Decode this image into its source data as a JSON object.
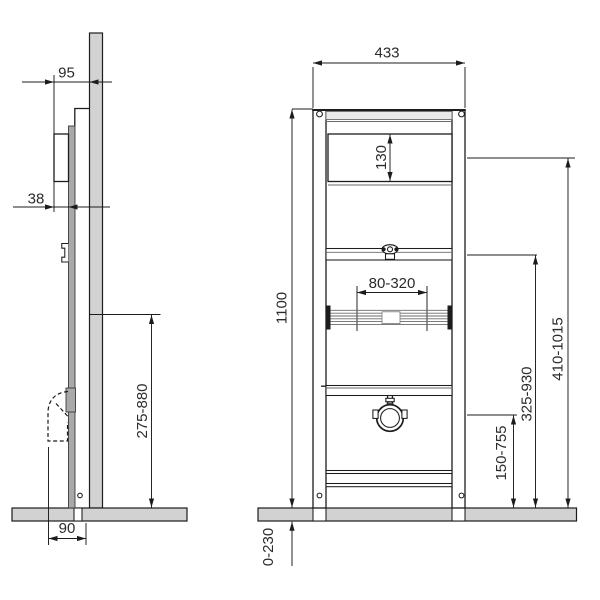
{
  "drawing": {
    "title": "Concealed cistern installation frame — dimension drawing",
    "units": "mm"
  },
  "views": {
    "side": {
      "name": "side-view",
      "dimensions": {
        "frame_depth": "95",
        "cistern_depth": "38",
        "outlet_height_range": "275-880",
        "base_depth": "90"
      }
    },
    "front": {
      "name": "front-view",
      "dimensions": {
        "frame_width": "433",
        "flush_window_height": "130",
        "frame_height": "1100",
        "bracket_spacing_range": "80-320",
        "upper_fixing_height_range": "410-1015",
        "mid_fixing_height_range": "325-930",
        "lower_fixing_height_range": "150-755",
        "leg_height_range": "0-230"
      }
    }
  },
  "colors": {
    "line": "#1c1c1c",
    "panel_fill": "#d2d2d2",
    "rail_fill": "#a9a9a9",
    "background": "#ffffff"
  }
}
